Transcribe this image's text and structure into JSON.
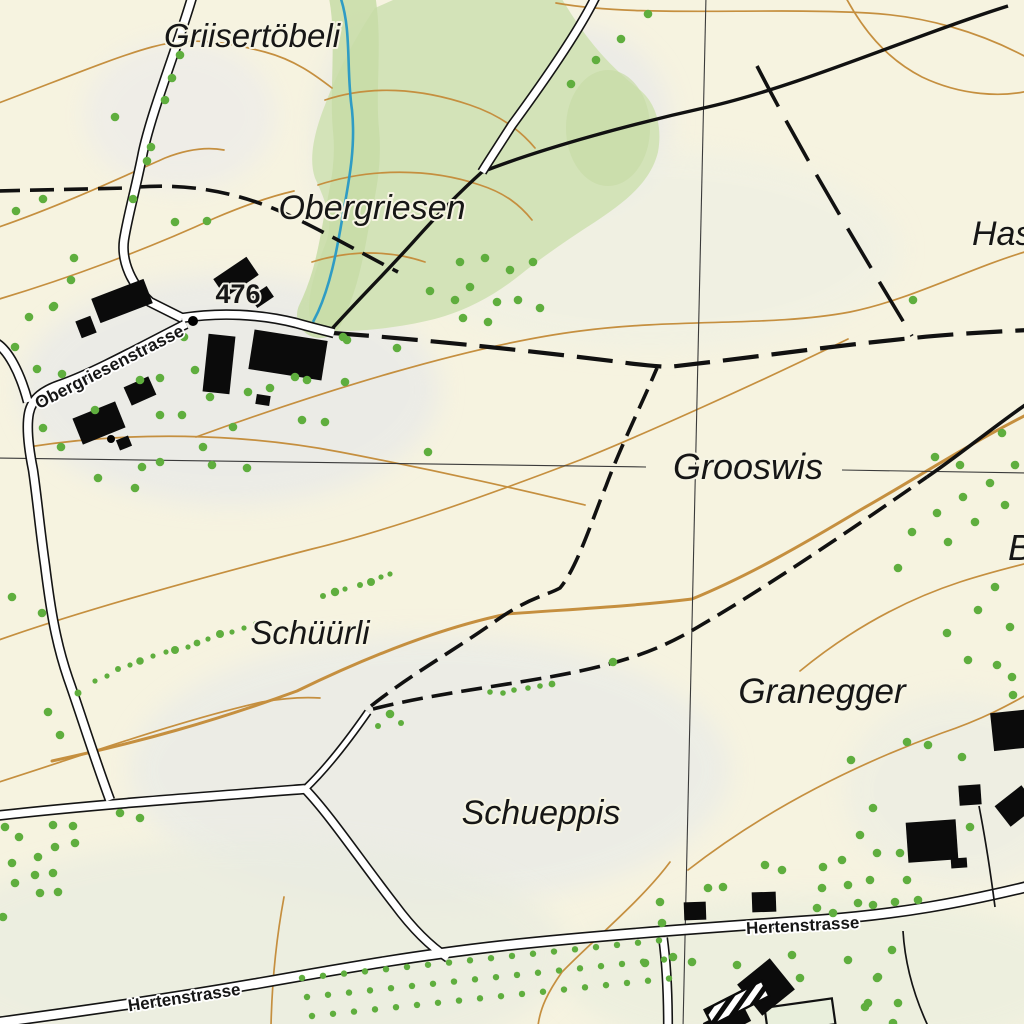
{
  "title": "Swiss topographic map extract",
  "colors": {
    "background": "#f6f3e0",
    "forest": "#d3e3b8",
    "forest_dark": "#c7dca6",
    "contour": "#c58f3f",
    "stream": "#2f9cc4",
    "road_fill": "#ffffff",
    "road_casing": "#141414",
    "trail": "#111111",
    "grid": "#3a3a3a",
    "building": "#0b0b0b",
    "tree": "#5fae3e",
    "plot_fill": "#e9efdc"
  },
  "labels": {
    "griisertoebeli": {
      "text": "Griisertöbeli"
    },
    "obergriesen": {
      "text": "Obergriesen"
    },
    "grooswis": {
      "text": "Grooswis"
    },
    "schuurli": {
      "text": "Schüürli"
    },
    "granegger": {
      "text": "Granegger"
    },
    "schueppis": {
      "text": "Schueppis"
    },
    "has_clipped": {
      "text": "Has"
    },
    "b_clipped": {
      "text": "B"
    },
    "obergriesenstrasse": {
      "text": "Obergriesenstrasse"
    },
    "hertenstrasse_right": {
      "text": "Hertenstrasse"
    },
    "hertenstrasse_left": {
      "text": "Hertenstrasse"
    },
    "spot_height": {
      "text": "476"
    }
  },
  "map": {
    "shade": [
      [
        180,
        115,
        95,
        75,
        "#e7e7f0",
        0.45
      ],
      [
        565,
        120,
        105,
        95,
        "#e2e4ed",
        0.5
      ],
      [
        370,
        145,
        55,
        120,
        "#dde1e6",
        0.45
      ],
      [
        230,
        390,
        210,
        115,
        "#e5e7ea",
        0.6
      ],
      [
        650,
        250,
        250,
        100,
        "#ecefe5",
        0.5
      ],
      [
        430,
        770,
        300,
        135,
        "#e6e9e9",
        0.6
      ],
      [
        960,
        790,
        115,
        95,
        "#e8ebe4",
        0.5
      ],
      [
        250,
        955,
        320,
        115,
        "#e9ece0",
        0.7
      ],
      [
        820,
        975,
        260,
        80,
        "#eaeede",
        0.75
      ]
    ],
    "forest": {
      "outline": "M402,-4 L560,-4 C575,20 595,55 640,90 C658,105 662,130 658,152 C650,185 620,205 595,222 C570,238 545,255 520,275 C495,295 470,308 445,316 C420,324 380,330 350,331 C330,332 315,328 310,318 C306,300 315,270 325,245 C335,222 325,200 315,178 C308,158 315,130 325,105 C340,65 360,30 375,8 Z",
      "dark_path": "M352,-4 C360,40 352,90 356,130 C360,170 350,200 344,235 C338,268 332,290 320,315",
      "blob": [
        608,
        128,
        42,
        58
      ]
    },
    "contours": [
      {
        "d": "M-4,104 C60,80 115,57 152,47 C195,35 235,44 265,52 C295,60 315,75 332,88"
      },
      {
        "d": "M-4,228 C60,206 120,178 165,158 C188,149 208,147 224,150"
      },
      {
        "d": "M-4,300 C70,278 150,248 215,218 C248,204 272,196 294,191"
      },
      {
        "d": "M196,437 C320,392 470,345 580,331 C680,318 770,327 850,312 C910,300 970,268 1028,251"
      },
      {
        "d": "M28,447 C130,431 240,433 340,452 C450,473 530,492 585,505"
      },
      {
        "d": "M-4,641 C80,611 200,578 312,549 C390,530 480,498 580,460 C640,436 760,382 848,339"
      },
      {
        "d": "M52,761 C140,742 215,721 297,691 C367,657 440,628 507,614 C575,609 635,606 692,599 C748,576 802,545 862,509 C905,485 965,446 1028,414",
        "index": true
      },
      {
        "d": "M-4,783 C90,753 182,720 262,702 C285,698 305,697 320,698"
      },
      {
        "d": "M670,862 C642,900 592,941 562,972 C548,992 540,1008 538,1026"
      },
      {
        "d": "M284,897 C276,940 272,980 271,1026"
      },
      {
        "d": "M688,870 C770,806 862,762 942,733 C986,718 1012,703 1028,694"
      },
      {
        "d": "M800,671 C850,630 905,600 960,582 C985,574 1008,568 1028,563"
      },
      {
        "d": "M556,3 C640,18 760,7 868,13 C925,16 980,32 1028,58"
      },
      {
        "d": "M845,-4 C862,28 885,58 922,77 C962,96 1002,97 1028,91"
      },
      {
        "d": "M325,100 C370,85 420,88 470,105 C500,115 520,130 535,148"
      },
      {
        "d": "M318,185 C370,168 430,168 480,185 C505,193 520,205 532,220"
      },
      {
        "d": "M312,262 C350,250 390,250 425,262"
      }
    ],
    "stream": "M340,-4 C352,30 346,70 352,110 C356,150 348,185 342,220 C336,255 330,285 318,312 L313,322",
    "grid": [
      {
        "d": "M706,-4 L683,1028"
      },
      {
        "d": "M-4,458 L646,467"
      },
      {
        "d": "M842,470 L1028,473"
      }
    ],
    "trails": [
      {
        "d": "M482,172 C462,190 440,212 415,240 C390,268 358,300 330,331",
        "w": 3.4
      },
      {
        "d": "M482,172 C545,147 640,122 708,107 C800,86 915,35 1008,6",
        "w": 3.4
      },
      {
        "d": "M927,477 C958,456 992,428 1028,403",
        "w": 3.6
      },
      {
        "d": "M-4,191 L128,188",
        "w": 3.6,
        "dash": "24,10"
      },
      {
        "d": "M138,187 C195,183 245,194 295,218 C330,235 365,255 398,272",
        "w": 3.6,
        "dash": "24,10"
      },
      {
        "d": "M333,333 C430,340 540,352 620,362 C640,365 655,366 668,367 C750,358 830,346 913,338 C950,334 990,332 1028,330",
        "w": 4.2,
        "dash": "36,13"
      },
      {
        "d": "M371,706 C410,675 455,650 497,620 C530,597 548,595 560,588 C577,568 592,520 606,486 C620,448 640,408 657,368",
        "w": 3.6,
        "dash": "21,9"
      },
      {
        "d": "M373,709 C440,692 520,684 580,671 C640,658 670,644 703,624 C765,588 855,527 927,477",
        "w": 3.6,
        "dash": "21,9"
      },
      {
        "d": "M757,66 C800,150 860,250 912,336",
        "w": 3.6,
        "dash": "46,16"
      }
    ],
    "roads": [
      {
        "d": "M193,-6 C180,40 152,110 143,152 C136,188 128,215 124,240 C121,262 132,285 150,302 L182,318",
        "w": 7.5
      },
      {
        "d": "M182,318 C220,312 260,314 296,323 C310,327 322,330 334,333",
        "w": 7.5
      },
      {
        "d": "M186,324 C150,342 96,372 62,384 C44,390 32,398 29,413 C26,428 29,450 33,470 C37,497 40,530 45,565 C50,605 55,640 68,678 C80,712 95,760 110,800",
        "w": 7.5
      },
      {
        "d": "M-4,343 C8,350 20,372 28,402",
        "w": 7.5
      },
      {
        "d": "M597,-6 C580,30 545,80 512,125 C498,147 488,162 482,172",
        "w": 7
      },
      {
        "d": "M-6,816 C80,806 200,797 305,789",
        "w": 7.5
      },
      {
        "d": "M305,789 C325,770 345,745 368,712",
        "w": 5
      },
      {
        "d": "M305,789 C330,815 360,860 395,905 C412,928 430,946 448,958",
        "w": 7
      },
      {
        "d": "M-6,1023 C60,1014 150,1002 260,983 C350,967 420,955 500,946 C580,937 700,928 820,920 C900,914 960,903 1030,886",
        "w": 8.5
      },
      {
        "d": "M663,938 C666,960 668,990 668,1028",
        "w": 7
      }
    ],
    "fences": [
      {
        "d": "M979,806 C986,842 991,876 995,907"
      },
      {
        "d": "M903,931 C905,965 914,996 928,1026"
      }
    ],
    "buildings": [
      [
        122,
        301,
        56,
        26,
        -21
      ],
      [
        86,
        327,
        16,
        18,
        -21
      ],
      [
        236,
        277,
        40,
        22,
        -34
      ],
      [
        262,
        297,
        20,
        13,
        -34
      ],
      [
        219,
        364,
        27,
        58,
        6
      ],
      [
        288,
        355,
        74,
        40,
        9
      ],
      [
        263,
        400,
        14,
        10,
        9
      ],
      [
        140,
        391,
        27,
        20,
        -24
      ],
      [
        99,
        423,
        46,
        28,
        -22
      ],
      [
        124,
        443,
        13,
        11,
        -22
      ],
      [
        932,
        841,
        50,
        40,
        -4
      ],
      [
        959,
        863,
        16,
        10,
        -4
      ],
      [
        970,
        795,
        22,
        20,
        -4
      ],
      [
        1013,
        730,
        42,
        38,
        -6
      ],
      [
        1016,
        806,
        34,
        26,
        -38
      ],
      [
        695,
        911,
        22,
        18,
        -2
      ],
      [
        764,
        902,
        24,
        20,
        -2
      ],
      [
        766,
        987,
        42,
        40,
        -39
      ],
      [
        727,
        1022,
        44,
        20,
        -27
      ]
    ],
    "hatched_building": [
      737,
      1003,
      64,
      17,
      -27
    ],
    "outlined_plot": [
      800,
      1016,
      68,
      26,
      -8
    ],
    "spot_dot": [
      193,
      321,
      5
    ],
    "building_dot": [
      111,
      439,
      4
    ],
    "trees": [
      [
        180,
        55
      ],
      [
        172,
        78
      ],
      [
        165,
        100
      ],
      [
        115,
        117
      ],
      [
        151,
        147
      ],
      [
        147,
        161
      ],
      [
        133,
        199
      ],
      [
        648,
        14
      ],
      [
        621,
        39
      ],
      [
        596,
        60
      ],
      [
        571,
        84
      ],
      [
        430,
        291
      ],
      [
        455,
        300
      ],
      [
        470,
        287
      ],
      [
        497,
        302
      ],
      [
        518,
        300
      ],
      [
        540,
        308
      ],
      [
        460,
        262
      ],
      [
        485,
        258
      ],
      [
        510,
        270
      ],
      [
        533,
        262
      ],
      [
        463,
        318
      ],
      [
        488,
        322
      ],
      [
        16,
        211
      ],
      [
        43,
        199
      ],
      [
        74,
        258
      ],
      [
        71,
        280
      ],
      [
        54,
        306
      ],
      [
        29,
        317
      ],
      [
        15,
        347
      ],
      [
        37,
        369
      ],
      [
        62,
        374
      ],
      [
        175,
        222
      ],
      [
        207,
        221
      ],
      [
        95,
        410
      ],
      [
        140,
        380
      ],
      [
        160,
        378
      ],
      [
        184,
        337
      ],
      [
        195,
        370
      ],
      [
        210,
        397
      ],
      [
        160,
        415
      ],
      [
        182,
        415
      ],
      [
        203,
        447
      ],
      [
        160,
        462
      ],
      [
        142,
        467
      ],
      [
        233,
        427
      ],
      [
        248,
        392
      ],
      [
        270,
        388
      ],
      [
        295,
        377
      ],
      [
        307,
        380
      ],
      [
        212,
        465
      ],
      [
        247,
        468
      ],
      [
        302,
        420
      ],
      [
        325,
        422
      ],
      [
        343,
        337
      ],
      [
        345,
        382
      ],
      [
        61,
        447
      ],
      [
        43,
        428
      ],
      [
        135,
        488
      ],
      [
        98,
        478
      ],
      [
        53,
        307
      ],
      [
        428,
        452
      ],
      [
        347,
        340
      ],
      [
        397,
        348
      ],
      [
        12,
        597
      ],
      [
        42,
        613
      ],
      [
        48,
        712
      ],
      [
        60,
        735
      ],
      [
        390,
        714
      ],
      [
        401,
        723,
        3
      ],
      [
        378,
        726,
        3
      ],
      [
        490,
        692,
        2.8
      ],
      [
        503,
        693,
        2.8
      ],
      [
        514,
        690,
        2.8
      ],
      [
        528,
        688,
        2.8
      ],
      [
        540,
        686,
        2.8
      ],
      [
        552,
        684,
        3.4
      ],
      [
        613,
        662
      ],
      [
        1002,
        433
      ],
      [
        935,
        457
      ],
      [
        960,
        465
      ],
      [
        1015,
        465
      ],
      [
        990,
        483
      ],
      [
        963,
        497
      ],
      [
        1005,
        505
      ],
      [
        937,
        513
      ],
      [
        975,
        522
      ],
      [
        912,
        532
      ],
      [
        948,
        542
      ],
      [
        995,
        587
      ],
      [
        898,
        568
      ],
      [
        978,
        610
      ],
      [
        1010,
        627
      ],
      [
        947,
        633
      ],
      [
        968,
        660
      ],
      [
        997,
        665
      ],
      [
        1012,
        677
      ],
      [
        1013,
        695
      ],
      [
        913,
        300
      ],
      [
        907,
        742
      ],
      [
        928,
        745
      ],
      [
        962,
        757
      ],
      [
        851,
        760
      ],
      [
        873,
        808
      ],
      [
        860,
        835
      ],
      [
        877,
        853
      ],
      [
        900,
        853
      ],
      [
        870,
        880
      ],
      [
        907,
        880
      ],
      [
        918,
        900
      ],
      [
        873,
        905
      ],
      [
        895,
        902
      ],
      [
        970,
        827
      ],
      [
        892,
        950
      ],
      [
        878,
        977
      ],
      [
        868,
        1003
      ],
      [
        898,
        1003
      ],
      [
        893,
        1023
      ],
      [
        848,
        960
      ],
      [
        877,
        978
      ],
      [
        865,
        1007
      ],
      [
        708,
        888
      ],
      [
        723,
        887
      ],
      [
        660,
        902
      ],
      [
        662,
        923
      ],
      [
        765,
        865
      ],
      [
        782,
        870
      ],
      [
        823,
        867
      ],
      [
        842,
        860
      ],
      [
        817,
        908
      ],
      [
        833,
        913
      ],
      [
        848,
        885
      ],
      [
        858,
        903
      ],
      [
        822,
        888
      ],
      [
        673,
        957
      ],
      [
        692,
        962
      ],
      [
        737,
        965
      ],
      [
        792,
        955
      ],
      [
        800,
        978
      ],
      [
        645,
        963
      ],
      [
        53,
        825
      ],
      [
        73,
        826
      ],
      [
        19,
        837
      ],
      [
        12,
        863
      ],
      [
        38,
        857
      ],
      [
        55,
        847
      ],
      [
        75,
        843
      ],
      [
        35,
        875
      ],
      [
        53,
        873
      ],
      [
        58,
        892
      ],
      [
        40,
        893
      ],
      [
        15,
        883
      ],
      [
        3,
        917
      ],
      [
        5,
        827
      ],
      [
        120,
        813
      ],
      [
        140,
        818
      ]
    ],
    "tree_rows": [
      [
        [
          78,
          693,
          3.5
        ],
        [
          95,
          681,
          2.6
        ],
        [
          107,
          676,
          2.6
        ],
        [
          118,
          669,
          3
        ],
        [
          130,
          665,
          2.6
        ],
        [
          140,
          661,
          3.8
        ],
        [
          153,
          656,
          2.6
        ],
        [
          166,
          652,
          2.6
        ],
        [
          175,
          650,
          4
        ],
        [
          188,
          647,
          2.6
        ],
        [
          197,
          643,
          3.4
        ],
        [
          208,
          639,
          2.6
        ],
        [
          220,
          634,
          4
        ],
        [
          232,
          632,
          2.6
        ],
        [
          244,
          628,
          2.6
        ],
        [
          256,
          624,
          3
        ]
      ],
      [
        [
          323,
          596,
          3
        ],
        [
          335,
          592,
          4.2
        ],
        [
          345,
          589,
          2.6
        ],
        [
          360,
          585,
          3
        ],
        [
          371,
          582,
          4
        ],
        [
          381,
          577,
          2.6
        ],
        [
          390,
          574,
          2.6
        ]
      ]
    ],
    "orchard": {
      "x0": 302,
      "y0": 978,
      "cols": 18,
      "rows": 3,
      "dx": 21,
      "dy": 19,
      "row_dx": 5,
      "slope": -0.105,
      "r": 3.2
    }
  }
}
